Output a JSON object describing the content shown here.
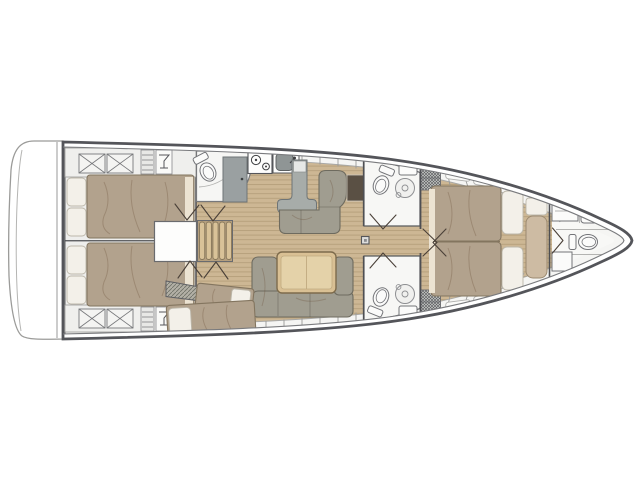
{
  "diagram": {
    "type": "sailboat-interior-floor-plan",
    "aria_label": "Sailboat interior layout plan, bow pointing right",
    "palette": {
      "background": "#ffffff",
      "hull_line": "#54555a",
      "deck_line": "#7a7b7e",
      "interior": "#f5f5f3",
      "cabin_floor": "#eeeeec",
      "wood_floor": "#cdb794",
      "wood_plank_line": "#b59f7b",
      "mattress": "#b2a28d",
      "mattress_edge": "#83755f",
      "pillow": "#f3f0e9",
      "pillow_edge": "#bcb7aa",
      "cream_strip": "#ece3d2",
      "sofa": "#a09d90",
      "sofa_outline": "#6e6b5f",
      "table_wood": "#d9c094",
      "table_inner": "#e4d2a9",
      "table_edge": "#7d6b4c",
      "counter_gray": "#a7aca9",
      "appliance_gray": "#9aa0a1",
      "sink_basin": "#8f9595",
      "chart_table": "#5a5044",
      "bench": "#cdbba3",
      "stair_wood": "#d9c298",
      "stair_edge": "#87775a",
      "fixture_white": "#fbfbfa",
      "fixture_line": "#737478",
      "wall": "#4e4f53",
      "door_swing": "#4a4038",
      "hatch_wall": "#b3b0a6"
    },
    "regions": [
      {
        "name": "swim-platform"
      },
      {
        "name": "aft-cabin-port"
      },
      {
        "name": "aft-cabin-starboard"
      },
      {
        "name": "bunk-cabin"
      },
      {
        "name": "companionway-stairs"
      },
      {
        "name": "aft-head-port"
      },
      {
        "name": "galley"
      },
      {
        "name": "dinette"
      },
      {
        "name": "salon"
      },
      {
        "name": "mid-head-port"
      },
      {
        "name": "mid-head-starboard"
      },
      {
        "name": "owner-cabin"
      },
      {
        "name": "forward-head"
      },
      {
        "name": "anchor-locker"
      }
    ]
  }
}
